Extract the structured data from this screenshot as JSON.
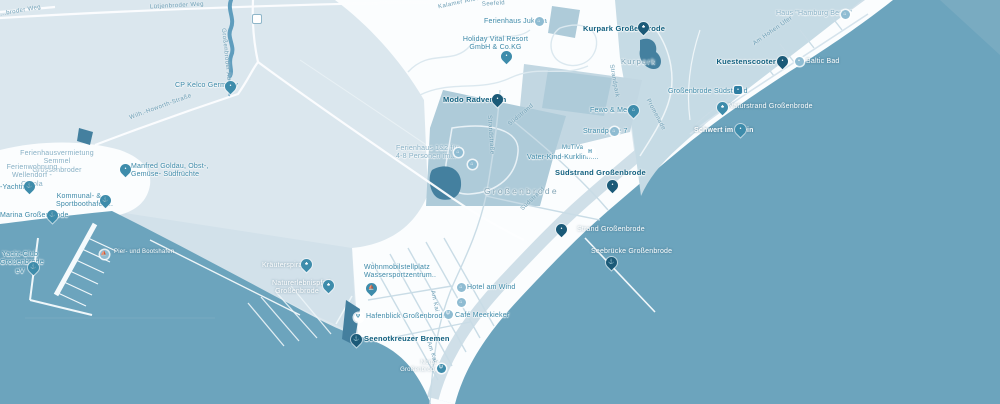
{
  "map": {
    "pois": {
      "kuestenscooter": {
        "label": "Kuestenscooter"
      },
      "stop_suedstrand": {
        "label": "Großenbrode Südstrand"
      },
      "naturstrand": {
        "label": "Naturstrand Großenbrode"
      },
      "schwert": {
        "label": "Schwert im Stein"
      },
      "haus_hamburg_berlin": {
        "label": "Haus \"Hamburg Berlin\""
      },
      "baltic": {
        "label": "Baltic Bad"
      },
      "kurpark_poi": {
        "label": "Kurpark Großenbrode"
      },
      "fewo_meer": {
        "label": "Fewo & Meer"
      },
      "strandperle": {
        "label": "Strandperle 7"
      },
      "mutiva": {
        "label": "MuTiVa"
      },
      "vater_kind": {
        "label": "Vater-Kind-Kurklinik..."
      },
      "suedstrand_poi": {
        "label": "Südstrand Großenbrode"
      },
      "strand_grossenbrode": {
        "label": "Strand Großenbrode"
      },
      "seebruecke": {
        "label": "Seebrücke Großenbrode"
      },
      "ferienhaus_jukana": {
        "label": "Ferienhaus Jukana"
      },
      "holiday_vital": {
        "label": "Holiday Vital Resort\nGmbH & Co.KG"
      },
      "modo_radverleih": {
        "label": "Modo Radverleih"
      },
      "ferienhaus_1_2": {
        "label": "Ferienhaus 1&2 für\n4-8 Personen im..."
      },
      "cp_kelco": {
        "label": "CP Kelco Germany"
      },
      "vermietung": {
        "label": "Ferienhausvermietung\nSemmel Grossenbroder"
      },
      "ferienwohnung": {
        "label": "Ferienwohnung\nWellendorf - Carola"
      },
      "yachting": {
        "label": "-Yachting"
      },
      "manfred_goldau": {
        "label": "Manfred Goldau, Obst-,\nGemüse- Südfrüchte"
      },
      "kommunal": {
        "label": "Kommunal- &\nSportboothafen..."
      },
      "marina": {
        "label": "Marina Großenbrode"
      },
      "yacht_club": {
        "label": "Yacht-Club\nGroßenbrode eV"
      },
      "pier_hafen": {
        "label": "Pier- und Bootshafen"
      },
      "wohnmobil": {
        "label": "Wohnmobilstellplatz\nWassersportzentrum.."
      },
      "kraeuterspirale": {
        "label": "Kräuterspirale"
      },
      "naturerlebnispfad": {
        "label": "Naturerlebnispfad\nGroßenbrode"
      },
      "hafenblick": {
        "label": "Hafenblick Großenbrode"
      },
      "seenotkreuzer": {
        "label": "Seenotkreuzer Bremen"
      },
      "hotel_am_wind": {
        "label": "Hotel am Wind"
      },
      "cafe_meerkieker": {
        "label": "Café  Meerkieker"
      },
      "norbu": {
        "label": "Norbu\nGroßenbrode"
      }
    },
    "roads": {
      "luetjenbroder_weg": "Lütjenbroder Weg",
      "broder_weg": "...broder Weg",
      "grossenbroder_au": "Großenbroder Au",
      "howorth": "Wilh.-Howorth-Straße",
      "allee": "Kalamer Allee",
      "seefeld": "Seefeld",
      "strandstrasse": "Strandstraße",
      "suedstrand1": "Südstrand",
      "suedstrand2": "Südstrand",
      "strandpark": "Strandpark",
      "promenade": "Promenade",
      "am_hohen_ufer": "Am Hohen Ufer",
      "am_kai_1": "Am Kai",
      "am_kai_2": "Am Kai"
    },
    "areas": {
      "kurpark": "Kurpark",
      "town": "Großenbrode"
    }
  },
  "icons": {
    "bed": "⌂",
    "food": "Ψ",
    "tree": "♣",
    "anchor": "⚓",
    "hospital": "H",
    "dot": "•",
    "boat": "⛵"
  },
  "colors": {
    "water": "#6ca4bd",
    "land": "#dbe7ee",
    "urban_white": "#fbfdfe",
    "zone_teal": "#aecbd9",
    "park_teal": "#c6dbe5",
    "pond_dark": "#44809f",
    "pin_dark": "#1b5a78",
    "pin_teal": "#3e8cab",
    "text_dark": "#11607f",
    "text_teal": "#3c89a8",
    "text_road": "#6b9db4",
    "text_white": "#ffffff"
  }
}
